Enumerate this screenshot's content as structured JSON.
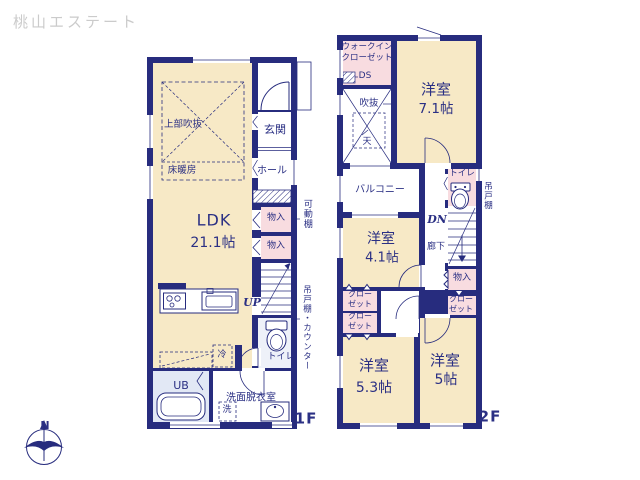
{
  "logo": {
    "text": "桃山エステート",
    "color": "#cbcbcb"
  },
  "colors": {
    "wall_navy": "#272c7e",
    "room_beige": "#f7e9c6",
    "closet_pink": "#f8dce0",
    "bath_blue": "#e2e8f5",
    "text_navy": "#2b3084"
  },
  "compass": {
    "north_label": "N"
  },
  "floor1": {
    "floor_label": "1F",
    "ldk": {
      "name": "LDK",
      "size": "21.1帖"
    },
    "upper_void": "上部吹抜",
    "floor_heating": "床暖房",
    "entrance": "玄関",
    "hall": "ホール",
    "storage_1": "物入",
    "storage_2": "物入",
    "stairs": "UP",
    "toilet": "トイレ",
    "refrigerator": "冷",
    "unit_bath": "UB",
    "washroom": "洗面脱衣室",
    "washer": "洗",
    "side_note_shelf": "可動棚",
    "side_note_counter": "吊戸棚・カウンター"
  },
  "floor2": {
    "floor_label": "2F",
    "walk_in_closet": "ウォークイン\nクローゼット",
    "duct_space": "DS",
    "void": "吹抜",
    "skylight": "天",
    "room_7_1": {
      "name": "洋室",
      "size": "7.1帖"
    },
    "balcony": "バルコニー",
    "room_4_1": {
      "name": "洋室",
      "size": "4.1帖"
    },
    "toilet": "トイレ",
    "stairs": "DN",
    "corridor": "廊下",
    "storage": "物入",
    "closet_right": "クロー\nゼット",
    "closet_left_1": "クロー\nゼット",
    "closet_left_2": "クロー\nゼット",
    "room_5_3": {
      "name": "洋室",
      "size": "5.3帖"
    },
    "room_5": {
      "name": "洋室",
      "size": "5帖"
    },
    "side_note_cupboard": "吊戸棚"
  }
}
